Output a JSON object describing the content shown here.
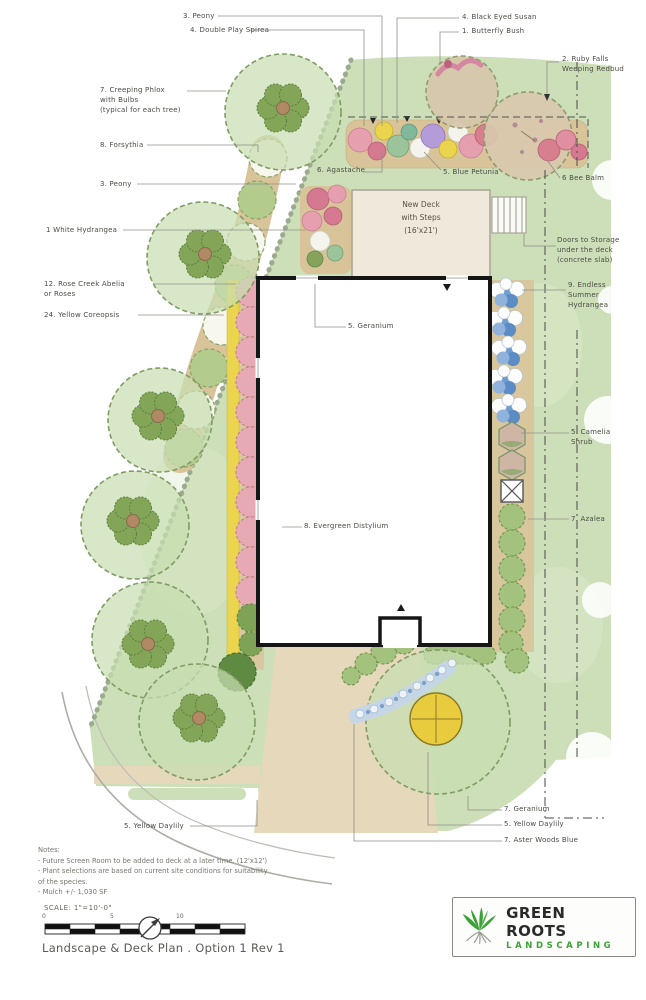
{
  "drawing": {
    "deck_label": "New Deck\nwith Steps\n(16'x21')",
    "labels": [
      {
        "text": "3. Peony"
      },
      {
        "text": "4. Double Play Spirea"
      },
      {
        "text": "4. Black Eyed Susan"
      },
      {
        "text": "1. Butterfly Bush"
      },
      {
        "text": "2. Ruby Falls\nWeeping Redbud"
      },
      {
        "text": "7. Creeping Phlox\nwith Bulbs\n(typical for each tree)"
      },
      {
        "text": "8. Forsythia"
      },
      {
        "text": "3. Peony"
      },
      {
        "text": "1 White Hydrangea"
      },
      {
        "text": "6. Agastache"
      },
      {
        "text": "5. Blue Petunia"
      },
      {
        "text": "6 Bee Balm"
      },
      {
        "text": "Doors to Storage\nunder the deck\n(concrete slab)"
      },
      {
        "text": "9. Endless\nSummer\nHydrangea"
      },
      {
        "text": "12. Rose Creek Abelia\nor Roses"
      },
      {
        "text": "24. Yellow Coreopsis"
      },
      {
        "text": "5. Geranium"
      },
      {
        "text": "5. Camelia\nShrub"
      },
      {
        "text": "7. Azalea"
      },
      {
        "text": "8. Evergreen Distylium"
      },
      {
        "text": "5. Yellow Daylily"
      },
      {
        "text": "7. Geranium"
      },
      {
        "text": "5. Yellow Daylily"
      },
      {
        "text": "7. Aster Woods Blue"
      }
    ]
  },
  "title_block": {
    "notes": "Notes:\n- Future Screen Room to be added to deck at a later time. (12'x12')\n- Plant selections are based on current site conditions for suitability\nof the species.\n- Mulch +/- 1,030 SF",
    "scale_label": "SCALE: 1\"=10'-0\"",
    "scale_ticks": [
      "0",
      "5",
      "10"
    ],
    "drawing_title": "Landscape & Deck Plan . Option 1 Rev 1"
  },
  "logo": {
    "name": "GREEN ROOTS",
    "subtitle": "LANDSCAPING",
    "accent_color": "#3aa335"
  },
  "colors": {
    "lawn_green": "#cddfb8",
    "planting_bed_tan": "#d9c49a",
    "house_outline": "#161616"
  }
}
